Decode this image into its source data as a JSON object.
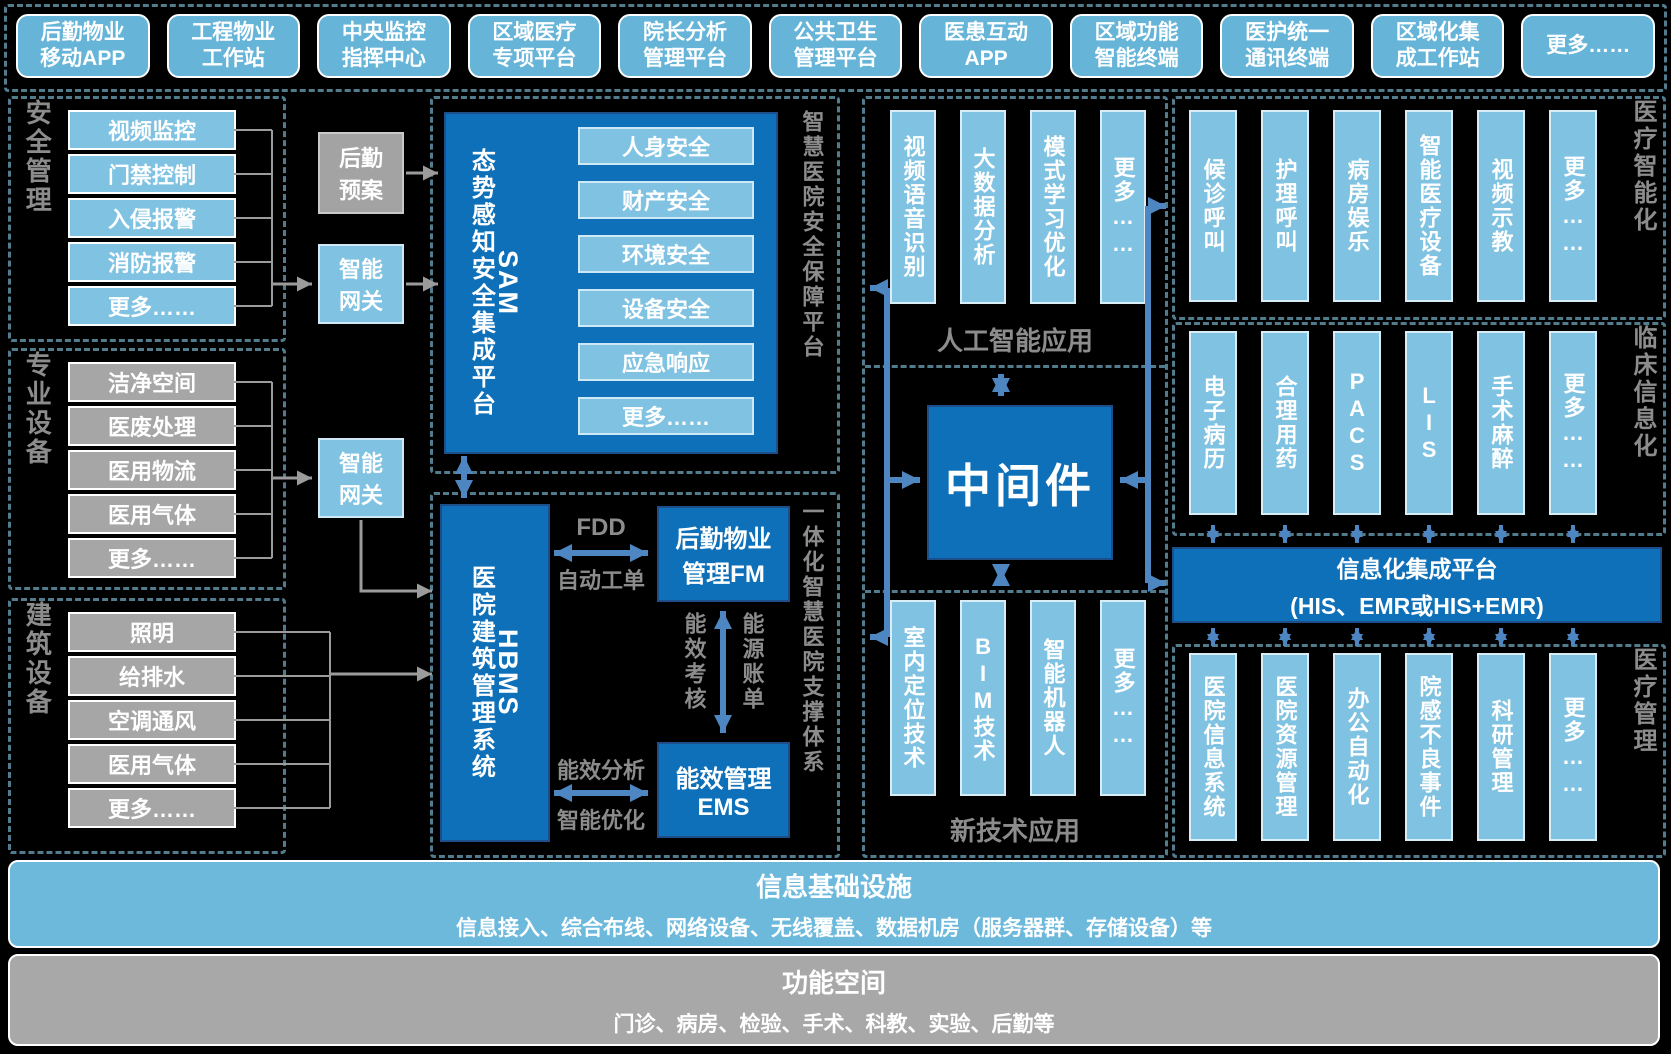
{
  "palette": {
    "dark_blue": "#0e70b9",
    "light_blue_box": "#66b5d9",
    "column_blue": "#7fc2e1",
    "gray_box": "#a6a6a6",
    "dash_border": "#527c8e",
    "gray_text": "#8c8c8c",
    "blue_arrow": "#4e86c2",
    "gray_line": "#9b9b9b",
    "background": "#000000"
  },
  "top_apps": [
    "后勤物业\n移动APP",
    "工程物业\n工作站",
    "中央监控\n指挥中心",
    "区域医疗\n专项平台",
    "院长分析\n管理平台",
    "公共卫生\n管理平台",
    "医患互动\nAPP",
    "区域功能\n智能终端",
    "医护统一\n通讯终端",
    "区域化集\n成工作站",
    "更多……"
  ],
  "left_groups": [
    {
      "label": "安全管理",
      "items": [
        "视频监控",
        "门禁控制",
        "入侵报警",
        "消防报警",
        "更多……"
      ]
    },
    {
      "label": "专业设备",
      "items": [
        "洁净空间",
        "医废处理",
        "医用物流",
        "医用气体",
        "更多……"
      ]
    },
    {
      "label": "建筑设备",
      "items": [
        "照明",
        "给排水",
        "空调通风",
        "医用气体",
        "更多……"
      ]
    }
  ],
  "gateway": {
    "logistics_plan": "后勤\n预案",
    "smart_gateway_1": "智能\n网关",
    "smart_gateway_2": "智能\n网关"
  },
  "sam": {
    "code": "SAM",
    "title": "态势感知安全集成平台",
    "items": [
      "人身安全",
      "财产安全",
      "环境安全",
      "设备安全",
      "应急响应",
      "更多……"
    ],
    "section_label": "智慧医院安全保障平台"
  },
  "hbms": {
    "code": "HBMS",
    "title": "医院建筑管理系统",
    "fm": "后勤物业\n管理FM",
    "ems": "能效管理\nEMS",
    "section_label": "一体化智慧医院支撑体系",
    "links": {
      "fdd": "FDD",
      "auto_ticket": "自动工单",
      "energy_assess": "能效考核",
      "energy_bill": "能源账单",
      "energy_analysis": "能效分析",
      "smart_opt": "智能优化"
    }
  },
  "middle": {
    "ai": {
      "columns": [
        "视频语音识别",
        "大数据分析",
        "模式学习优化",
        "更多……"
      ],
      "label": "人工智能应用"
    },
    "middleware": "中间件",
    "newtech": {
      "columns": [
        "室内定位技术",
        "BIM技术",
        "智能机器人",
        "更多……"
      ],
      "label": "新技术应用"
    }
  },
  "right": {
    "medical_intelligence": {
      "label": "医疗智能化",
      "columns": [
        "候诊呼叫",
        "护理呼叫",
        "病房娱乐",
        "智能医疗设备",
        "视频示教",
        "更多……"
      ]
    },
    "clinical_informatization": {
      "label": "临床信息化",
      "columns": [
        "电子病历",
        "合理用药",
        "PACS",
        "LIS",
        "手术麻醉",
        "更多……"
      ]
    },
    "integration_platform": {
      "line1": "信息化集成平台",
      "line2": "(HIS、EMR或HIS+EMR)"
    },
    "medical_management": {
      "label": "医疗管理",
      "columns": [
        "医院信息系统",
        "医院资源管理",
        "办公自动化",
        "院感不良事件",
        "科研管理",
        "更多……"
      ]
    }
  },
  "bottom": {
    "info_infrastructure": {
      "title": "信息基础设施",
      "subtitle": "信息接入、综合布线、网络设备、无线覆盖、数据机房（服务器群、存储设备）等"
    },
    "functional_space": {
      "title": "功能空间",
      "subtitle": "门诊、病房、检验、手术、科教、实验、后勤等"
    }
  }
}
